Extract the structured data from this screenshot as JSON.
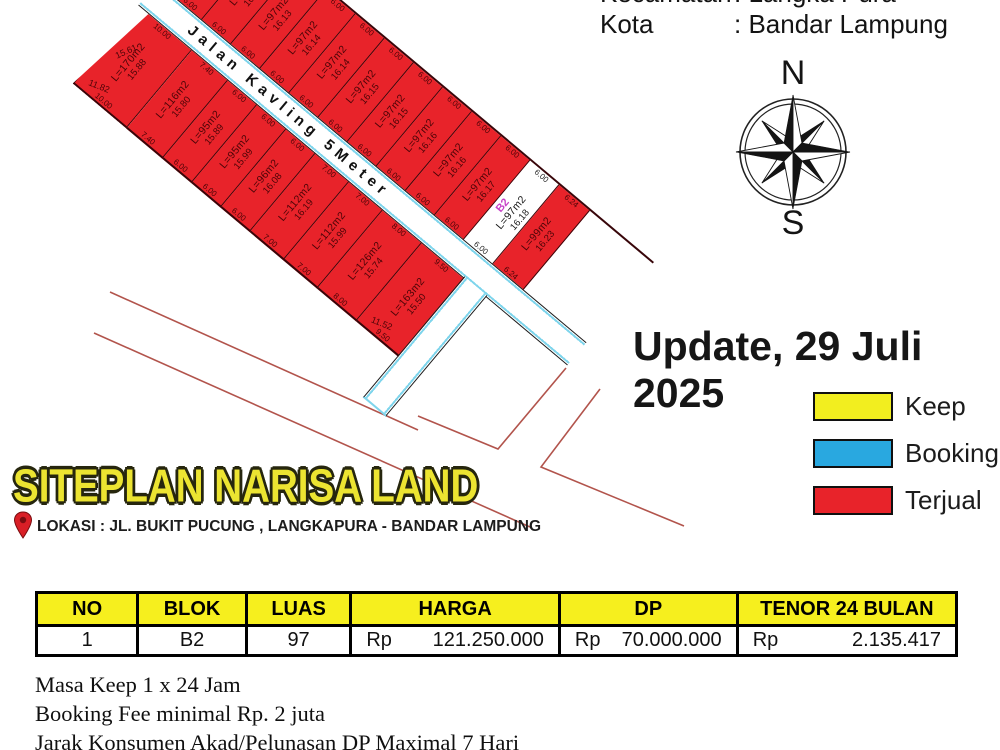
{
  "header": {
    "kecamatan_label": "Kecamatan",
    "kecamatan_value": ": Langka Pura",
    "kota_label": "Kota",
    "kota_value": ": Bandar Lampung"
  },
  "compass": {
    "north": "N",
    "south": "S"
  },
  "update_text": "Update, 29 Juli 2025",
  "legend": [
    {
      "label": "Keep",
      "color": "#f2ee1f"
    },
    {
      "label": "Booking",
      "color": "#29a8e0"
    },
    {
      "label": "Terjual",
      "color": "#e8232a"
    }
  ],
  "branding": {
    "title": "SITEPLAN NARISA LAND",
    "location": "LOKASI : JL. BUKIT PUCUNG , LANGKAPURA - BANDAR LAMPUNG"
  },
  "road": {
    "name": "Jalan Kavling 5Meter"
  },
  "plots": {
    "upper": [
      {
        "area": "L=97m2",
        "length": "16.13",
        "width": "6.00"
      },
      {
        "area": "L=97m2",
        "length": "16.13",
        "width": "6.00"
      },
      {
        "area": "L=97m2",
        "length": "16.13",
        "width": "6.00"
      },
      {
        "area": "L=97m2",
        "length": "16.14",
        "width": "6.00"
      },
      {
        "area": "L=97m2",
        "length": "16.14",
        "width": "6.00"
      },
      {
        "area": "L=97m2",
        "length": "16.15",
        "width": "6.00"
      },
      {
        "area": "L=97m2",
        "length": "16.15",
        "width": "6.00"
      },
      {
        "area": "L=97m2",
        "length": "16.16",
        "width": "6.00"
      },
      {
        "area": "L=97m2",
        "length": "16.16",
        "width": "6.00"
      },
      {
        "area": "L=97m2",
        "length": "16.17",
        "width": "6.00"
      },
      {
        "area": "L=97m2",
        "length": "16.18",
        "width": "6.00",
        "block": "B2",
        "status": "available"
      },
      {
        "area": "L=99m2",
        "length": "16.23",
        "width": "6.24"
      }
    ],
    "lower": [
      {
        "area": "L=170m2",
        "length": "15.88",
        "width": "10.00",
        "side": "15.61",
        "bottom": "11.82"
      },
      {
        "area": "L=116m2",
        "length": "15.80",
        "width": "7.40"
      },
      {
        "area": "L=95m2",
        "length": "15.89",
        "width": "6.00"
      },
      {
        "area": "L=95m2",
        "length": "15.99",
        "width": "6.00"
      },
      {
        "area": "L=96m2",
        "length": "16.08",
        "width": "6.00"
      },
      {
        "area": "L=112m2",
        "length": "16.19",
        "width": "7.00"
      },
      {
        "area": "L=112m2",
        "length": "15.99",
        "width": "7.00"
      },
      {
        "area": "L=126m2",
        "length": "15.74",
        "width": "8.00"
      },
      {
        "area": "L=163m2",
        "length": "15.50",
        "width": "9.50",
        "bottom": "11.52"
      }
    ]
  },
  "table": {
    "headers": [
      "NO",
      "BLOK",
      "LUAS",
      "HARGA",
      "DP",
      "TENOR 24 BULAN"
    ],
    "row": {
      "no": "1",
      "blok": "B2",
      "luas": "97",
      "harga_cur": "Rp",
      "harga": "121.250.000",
      "dp_cur": "Rp",
      "dp": "70.000.000",
      "tenor_cur": "Rp",
      "tenor": "2.135.417"
    }
  },
  "notes": [
    "Masa Keep 1 x 24 Jam",
    "Booking Fee minimal Rp. 2 juta",
    "Jarak Konsumen Akad/Pelunasan DP Maximal 7 Hari"
  ]
}
